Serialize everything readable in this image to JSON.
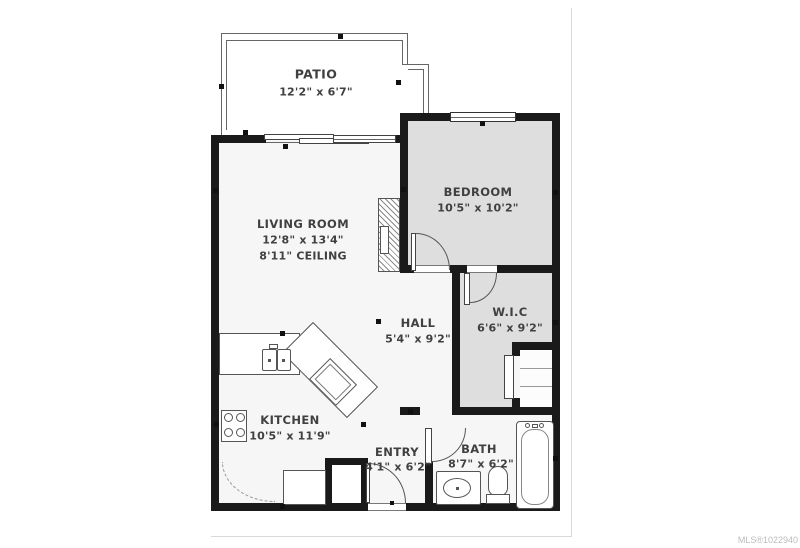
{
  "watermark": "MLS®1022940",
  "rooms": [
    {
      "id": "patio",
      "name": "PATIO",
      "dims": "12'2\" x 6'7\""
    },
    {
      "id": "living",
      "name": "LIVING ROOM",
      "dims": "12'8\" x 13'4\"",
      "extra": "8'11\" CEILING"
    },
    {
      "id": "bedroom",
      "name": "BEDROOM",
      "dims": "10'5\" x 10'2\""
    },
    {
      "id": "wic",
      "name": "W.I.C",
      "dims": "6'6\" x 9'2\""
    },
    {
      "id": "hall",
      "name": "HALL",
      "dims": "5'4\" x 9'2\""
    },
    {
      "id": "kitchen",
      "name": "KITCHEN",
      "dims": "10'5\" x 11'9\""
    },
    {
      "id": "entry",
      "name": "ENTRY",
      "dims": "4'1\" x 6'2\""
    },
    {
      "id": "bath",
      "name": "BATH",
      "dims": "8'7\" x 6'2\""
    }
  ],
  "colors": {
    "wall": "#1a1a1a",
    "room_gray": "#dedede",
    "room_light": "#f6f6f6",
    "line": "#555555",
    "text": "#404040",
    "watermark_gray": "#bcbcbc"
  }
}
